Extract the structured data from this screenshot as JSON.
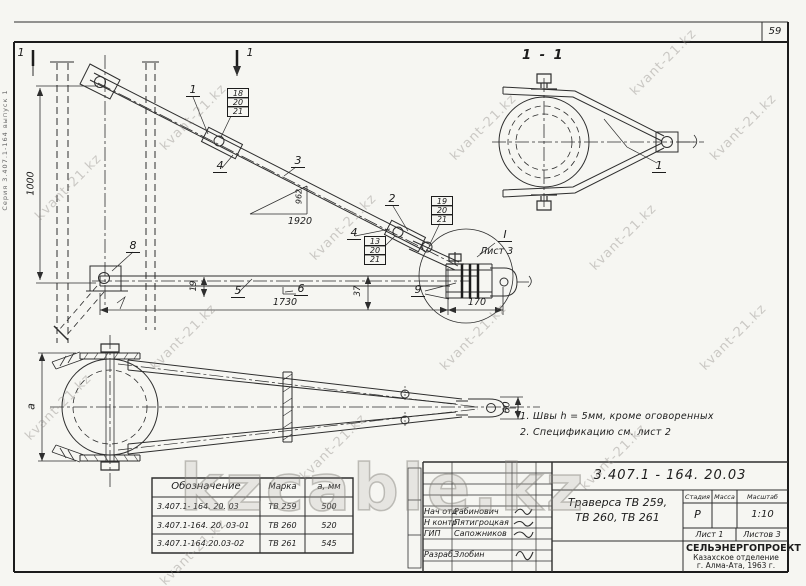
{
  "page": {
    "sheet_number": "59",
    "margin_note": "Серия 3.407.1-164 выпуск 1"
  },
  "watermarks": {
    "small": "kvant-21.kz",
    "large": "kzcable.kz"
  },
  "elevation": {
    "section_mark": "1",
    "labels": {
      "l1": "1",
      "l2": "2",
      "l3": "3",
      "l4a": "4",
      "l4b": "4",
      "l5": "5",
      "l6": "6",
      "l8": "8",
      "l9": "9"
    },
    "stack_a": [
      "18",
      "20",
      "21"
    ],
    "stack_b": [
      "19",
      "20",
      "21"
    ],
    "stack_c": [
      "13",
      "20",
      "21"
    ],
    "dims": {
      "height": "1000",
      "rise": "962",
      "run": "1920",
      "length": "1730",
      "end": "170",
      "d37": "37",
      "d19": "19"
    },
    "detail": {
      "mark": "I",
      "sheet": "Лист 3"
    }
  },
  "section_view": {
    "title": "1 - 1",
    "label1": "1"
  },
  "plan": {
    "dim_a": "а",
    "dim_60": "60"
  },
  "notes": {
    "n1": "1. Швы h = 5мм, кроме оговоренных",
    "n2": "2. Спецификацию  см. лист 2"
  },
  "spec_table": {
    "h_designation": "Обозначение",
    "h_mark": "Марка",
    "h_a": "а, мм",
    "rows": [
      {
        "designation": "3.407.1- 164. 20. 03",
        "mark": "ТВ 259",
        "a": "500"
      },
      {
        "designation": "3.407.1-164. 20. 03-01",
        "mark": "ТВ 260",
        "a": "520"
      },
      {
        "designation": "3.407.1-164.20.03-02",
        "mark": "ТВ 261",
        "a": "545"
      }
    ]
  },
  "title_block": {
    "doc_number": "3.407.1 - 164. 20.03",
    "title1": "Траверса  ТВ 259,",
    "title2": "ТВ 260, ТВ 261",
    "h_stage": "Стадия",
    "h_mass": "Масса",
    "h_scale": "Масштаб",
    "stage": "Р",
    "scale": "1:10",
    "sheet": "Лист 1",
    "sheets": "Листов 3",
    "org1": "СЕЛЬЭНЕРГОПРОЕКТ",
    "org2": "Казахское отделение",
    "org3": "г. Алма-Ата, 1963 г.",
    "r1_role": "Нач отд",
    "r1_name": "Рабинович",
    "r2_role": "Н контр",
    "r2_name": "Пятигроцкая",
    "r3_role": "ГИП",
    "r3_name": "Сапожников",
    "r4_role": "Разраб.",
    "r4_name": "Злобин"
  }
}
